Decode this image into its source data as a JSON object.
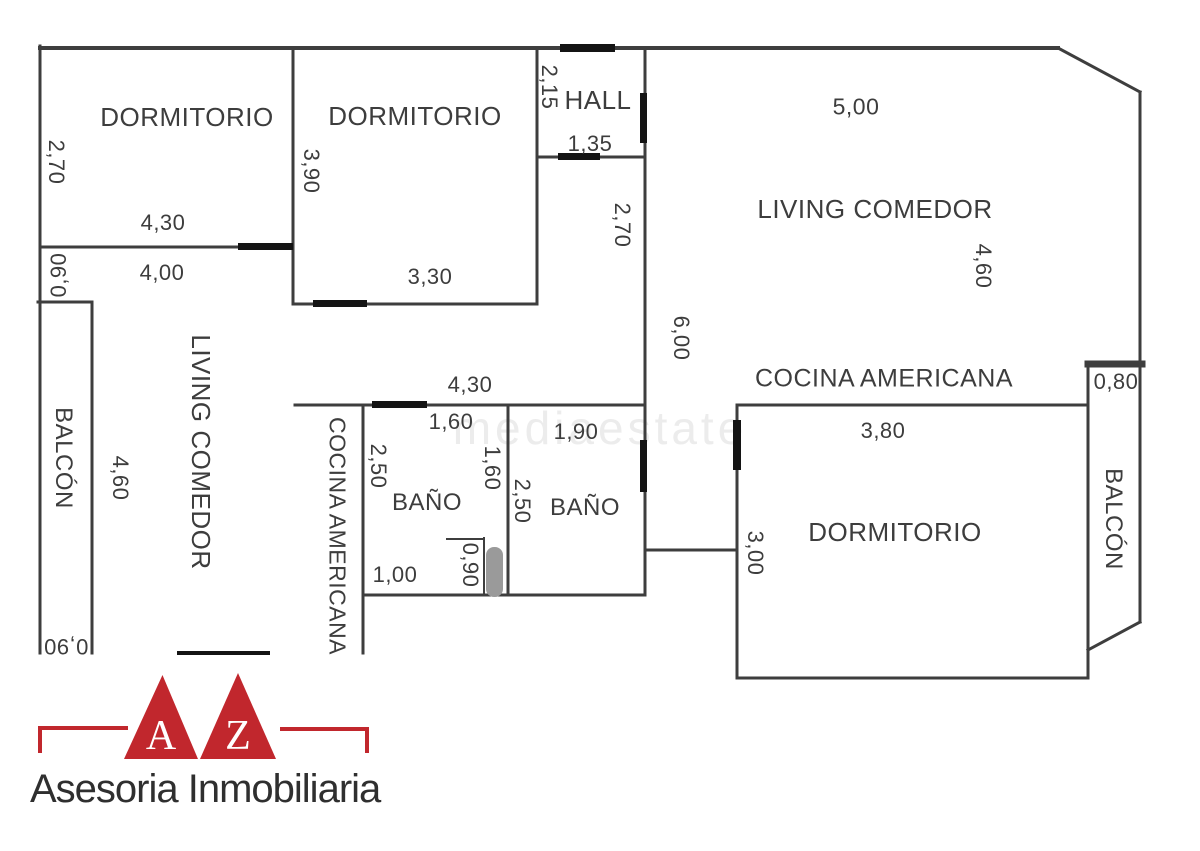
{
  "plan": {
    "wall_color": "#3e3e3e",
    "door_color": "#141414",
    "shower_color": "#9a9a9a",
    "walls": [
      [
        40,
        48,
        1058,
        48,
        4
      ],
      [
        1058,
        48,
        1140,
        92,
        3
      ],
      [
        1140,
        92,
        1140,
        622,
        3
      ],
      [
        1140,
        622,
        1088,
        650,
        3
      ],
      [
        40,
        46,
        40,
        653,
        3
      ],
      [
        293,
        48,
        293,
        304,
        3
      ],
      [
        537,
        48,
        537,
        304,
        3
      ],
      [
        645,
        48,
        645,
        595,
        3
      ],
      [
        40,
        247,
        293,
        247,
        3
      ],
      [
        293,
        304,
        537,
        304,
        3
      ],
      [
        537,
        157,
        645,
        157,
        3
      ],
      [
        38,
        302,
        92,
        302,
        3
      ],
      [
        92,
        302,
        92,
        653,
        3
      ],
      [
        295,
        405,
        645,
        405,
        3
      ],
      [
        363,
        405,
        363,
        653,
        3
      ],
      [
        508,
        405,
        508,
        595,
        3
      ],
      [
        484,
        538,
        484,
        595,
        2
      ],
      [
        447,
        539,
        484,
        539,
        2
      ],
      [
        363,
        595,
        645,
        595,
        3
      ],
      [
        645,
        550,
        737,
        550,
        3
      ],
      [
        737,
        405,
        737,
        678,
        3
      ],
      [
        737,
        678,
        1088,
        678,
        3
      ],
      [
        737,
        405,
        1088,
        405,
        3
      ],
      [
        1088,
        362,
        1088,
        678,
        3
      ],
      [
        1088,
        364,
        1142,
        364,
        7
      ]
    ],
    "door_markers": [
      [
        560,
        44,
        55,
        8
      ],
      [
        640,
        93,
        7,
        50
      ],
      [
        558,
        153,
        42,
        7
      ],
      [
        238,
        243,
        55,
        7
      ],
      [
        313,
        300,
        54,
        7
      ],
      [
        372,
        401,
        55,
        7
      ],
      [
        640,
        440,
        7,
        52
      ],
      [
        733,
        420,
        8,
        50
      ],
      [
        177,
        651,
        93,
        4
      ]
    ],
    "shower": {
      "x": 486,
      "y": 547,
      "w": 17,
      "h": 50,
      "r": 8
    },
    "labels": [
      {
        "name": "room-label-dormitorio-1",
        "text": "DORMITORIO",
        "cx": 187,
        "cy": 117,
        "rot": 0,
        "size": 26
      },
      {
        "name": "dim-2-70-dorm1",
        "text": "2,70",
        "cx": 56,
        "cy": 162,
        "rot": 90,
        "size": 22
      },
      {
        "name": "dim-4-30-dorm1",
        "text": "4,30",
        "cx": 163,
        "cy": 223,
        "rot": 0,
        "size": 22
      },
      {
        "name": "dim-0-90-passage",
        "text": "0,90",
        "cx": 59,
        "cy": 275,
        "rot": -90,
        "size": 22
      },
      {
        "name": "dim-4-00-passage",
        "text": "4,00",
        "cx": 162,
        "cy": 273,
        "rot": 0,
        "size": 22
      },
      {
        "name": "room-label-dormitorio-2",
        "text": "DORMITORIO",
        "cx": 415,
        "cy": 116,
        "rot": 0,
        "size": 26
      },
      {
        "name": "dim-3-90-dorm2",
        "text": "3,90",
        "cx": 311,
        "cy": 171,
        "rot": 90,
        "size": 22
      },
      {
        "name": "dim-3-30-dorm2",
        "text": "3,30",
        "cx": 430,
        "cy": 277,
        "rot": 0,
        "size": 22
      },
      {
        "name": "dim-2-15-hall",
        "text": "2,15",
        "cx": 549,
        "cy": 87,
        "rot": 90,
        "size": 22
      },
      {
        "name": "room-label-hall",
        "text": "HALL",
        "cx": 598,
        "cy": 100,
        "rot": 0,
        "size": 26
      },
      {
        "name": "dim-1-35-hall",
        "text": "1,35",
        "cx": 590,
        "cy": 144,
        "rot": 0,
        "size": 22
      },
      {
        "name": "dim-2-70-corridor",
        "text": "2,70",
        "cx": 622,
        "cy": 225,
        "rot": 90,
        "size": 22
      },
      {
        "name": "dim-5-00-living",
        "text": "5,00",
        "cx": 856,
        "cy": 107,
        "rot": 0,
        "size": 23
      },
      {
        "name": "room-label-living-comedor-right",
        "text": "LIVING COMEDOR",
        "cx": 875,
        "cy": 209,
        "rot": 0,
        "size": 26
      },
      {
        "name": "dim-4-60-living",
        "text": "4,60",
        "cx": 983,
        "cy": 266,
        "rot": 90,
        "size": 22
      },
      {
        "name": "dim-6-00-living",
        "text": "6,00",
        "cx": 681,
        "cy": 338,
        "rot": 90,
        "size": 22
      },
      {
        "name": "room-label-cocina-americana-right",
        "text": "COCINA AMERICANA",
        "cx": 884,
        "cy": 379,
        "rot": 0,
        "size": 25
      },
      {
        "name": "dim-0-80-balcon",
        "text": "0,80",
        "cx": 1116,
        "cy": 382,
        "rot": 0,
        "size": 22
      },
      {
        "name": "room-label-balcon-right",
        "text": "BALCÓN",
        "cx": 1113,
        "cy": 519,
        "rot": 90,
        "size": 24
      },
      {
        "name": "dim-3-80-dorm3",
        "text": "3,80",
        "cx": 883,
        "cy": 431,
        "rot": 0,
        "size": 22
      },
      {
        "name": "room-label-dormitorio-3",
        "text": "DORMITORIO",
        "cx": 895,
        "cy": 532,
        "rot": 0,
        "size": 26
      },
      {
        "name": "dim-3-00-dorm3",
        "text": "3,00",
        "cx": 755,
        "cy": 553,
        "rot": 90,
        "size": 22
      },
      {
        "name": "room-label-balcon-left",
        "text": "BALCÓN",
        "cx": 63,
        "cy": 458,
        "rot": 90,
        "size": 24
      },
      {
        "name": "dim-4-60-left",
        "text": "4,60",
        "cx": 120,
        "cy": 478,
        "rot": 90,
        "size": 22
      },
      {
        "name": "room-label-living-comedor-left",
        "text": "LIVING COMEDOR",
        "cx": 201,
        "cy": 452,
        "rot": 90,
        "size": 26
      },
      {
        "name": "dim-0-90-balcon-left",
        "text": "0,90",
        "cx": 66,
        "cy": 646,
        "rot": 180,
        "size": 22
      },
      {
        "name": "dim-4-30-bath-block",
        "text": "4,30",
        "cx": 470,
        "cy": 385,
        "rot": 0,
        "size": 22
      },
      {
        "name": "dim-1-60-bano1",
        "text": "1,60",
        "cx": 451,
        "cy": 422,
        "rot": 0,
        "size": 22
      },
      {
        "name": "dim-2-50-bano1",
        "text": "2,50",
        "cx": 378,
        "cy": 466,
        "rot": 90,
        "size": 22
      },
      {
        "name": "dim-1-60-bano1-v",
        "text": "1,60",
        "cx": 492,
        "cy": 468,
        "rot": 90,
        "size": 22
      },
      {
        "name": "dim-1-90-bano2",
        "text": "1,90",
        "cx": 576,
        "cy": 432,
        "rot": 0,
        "size": 22
      },
      {
        "name": "dim-2-50-bano2",
        "text": "2,50",
        "cx": 522,
        "cy": 501,
        "rot": 90,
        "size": 22
      },
      {
        "name": "room-label-bano-1",
        "text": "BAÑO",
        "cx": 427,
        "cy": 503,
        "rot": 0,
        "size": 24
      },
      {
        "name": "room-label-bano-2",
        "text": "BAÑO",
        "cx": 585,
        "cy": 508,
        "rot": 0,
        "size": 24
      },
      {
        "name": "dim-0-90-shower",
        "text": "0,90",
        "cx": 470,
        "cy": 565,
        "rot": 90,
        "size": 22
      },
      {
        "name": "dim-1-00-bano1",
        "text": "1,00",
        "cx": 395,
        "cy": 575,
        "rot": 0,
        "size": 22
      },
      {
        "name": "room-label-cocina-americana-left",
        "text": "COCINA AMERICANA",
        "cx": 337,
        "cy": 536,
        "rot": 90,
        "size": 23
      }
    ],
    "watermark": {
      "text": "mediaestate",
      "cx": 600,
      "cy": 428
    }
  },
  "logo": {
    "red": "#c1272d",
    "letter_a": "A",
    "letter_z": "Z",
    "company": "Asesoria Inmobiliaria"
  }
}
